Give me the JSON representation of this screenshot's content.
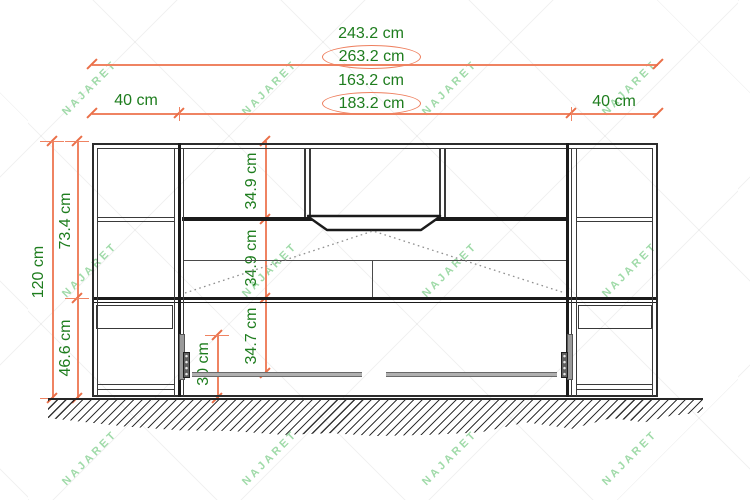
{
  "watermark": "NAJARET",
  "colors": {
    "dimension_line": "#ef8362",
    "dimension_text": "#1e7d1e",
    "watermark_green": "#8fd49a",
    "drawing_line": "#1b1b1b"
  },
  "dims": {
    "top_width": "243.2 cm",
    "top_width_revised": "263.2 cm",
    "inner_width": "163.2 cm",
    "inner_width_revised": "183.2 cm",
    "left_column_width": "40 cm",
    "right_column_width": "40 cm",
    "total_height": "120 cm",
    "upper_section_height": "73.4 cm",
    "lower_section_height": "46.6 cm",
    "top_shelf_height": "34.9 cm",
    "flap_height": "34.9 cm",
    "under_flap_height": "34.7 cm",
    "ground_clearance": "30 cm"
  }
}
